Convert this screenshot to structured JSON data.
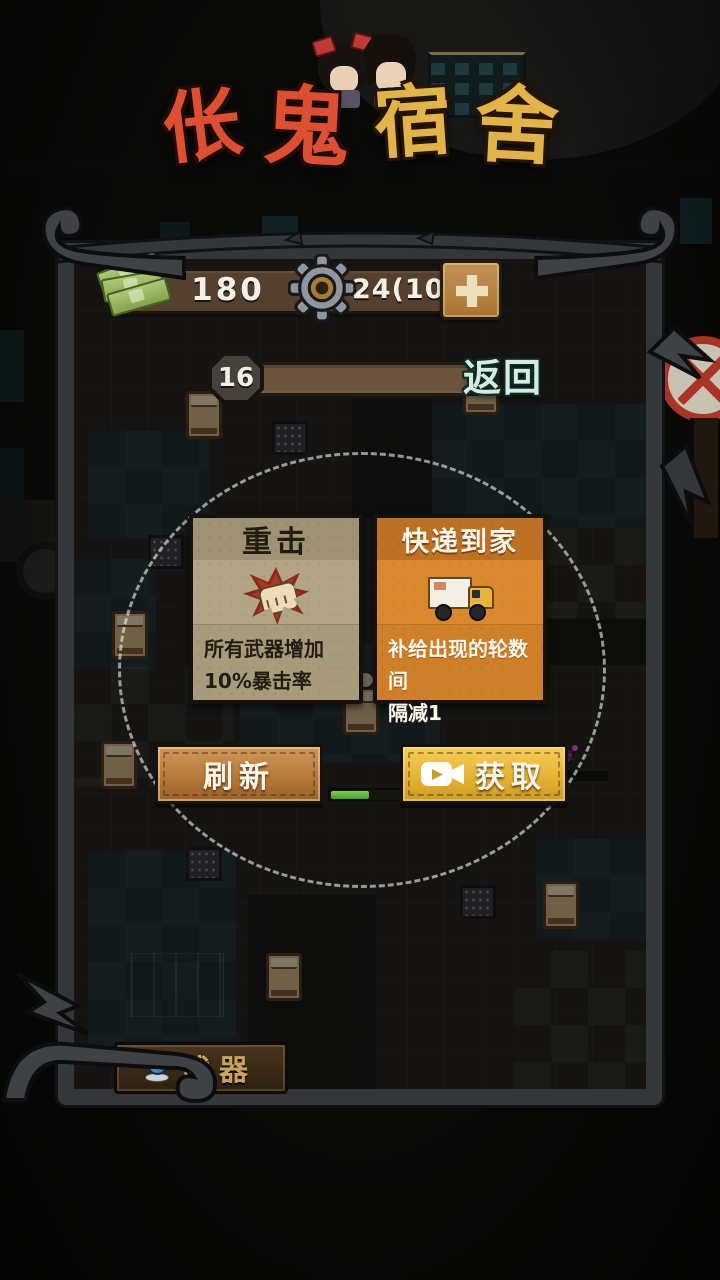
{
  "logo": {
    "title": "伥鬼宿舍",
    "chars": [
      "伥",
      "鬼",
      "宿",
      "舍"
    ]
  },
  "hud": {
    "money": "180",
    "gears": "24(109)",
    "round": "16",
    "back_label": "返回"
  },
  "upgrade_cards": [
    {
      "title": "重击",
      "desc_lines": [
        "所有武器增加",
        "10%暴击率"
      ],
      "icon": "fist-impact-icon",
      "theme": "tan"
    },
    {
      "title": "快递到家",
      "desc_lines": [
        "补给出现的轮数间",
        "隔减1"
      ],
      "icon": "delivery-truck-icon",
      "theme": "orange"
    }
  ],
  "actions": {
    "refresh_label": "刷新",
    "claim_label": "获取"
  },
  "bottom_bar": {
    "weapons_label": "武器"
  },
  "icons": {
    "money": "money-bills-icon",
    "gear": "gear-icon",
    "plus": "plus-icon",
    "claim": "video-camera-icon",
    "weapons": "weapon-orb-icon",
    "roadside": "no-entry-sign"
  },
  "colors": {
    "card_tan": "#b2a586",
    "card_orange": "#d9882d",
    "gold_button": "#e6b335",
    "copper_button": "#b67a3a",
    "hp_green": "#63b23d",
    "back_text": "#d6ece3"
  }
}
